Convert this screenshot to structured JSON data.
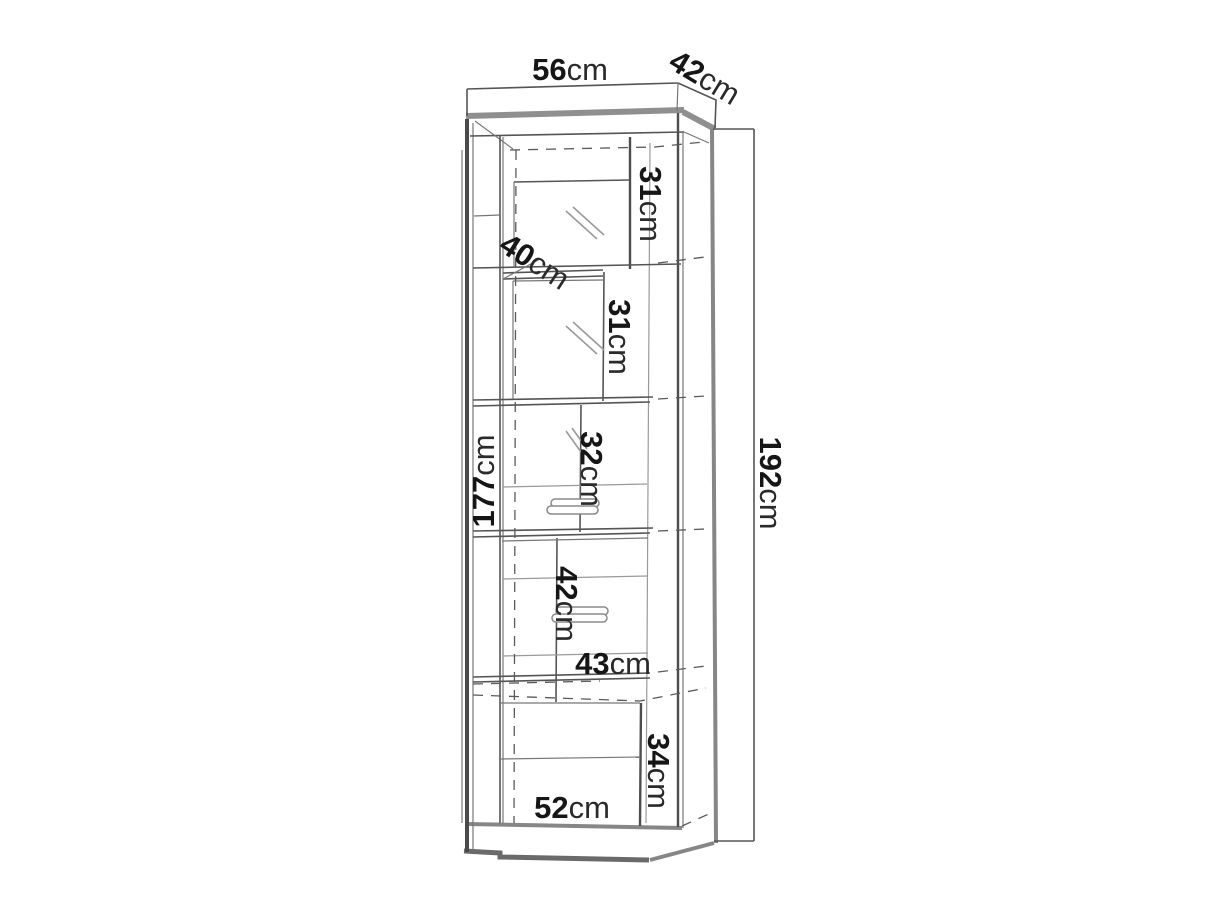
{
  "diagram": {
    "type": "furniture-dimension-drawing",
    "subject": "tall display cabinet, front elevation with dimension lines",
    "unit": "cm",
    "labels": {
      "top_width": {
        "value": "56",
        "unit": "cm"
      },
      "top_depth": {
        "value": "42",
        "unit": "cm"
      },
      "upper_shelf_1": {
        "value": "31",
        "unit": "cm"
      },
      "glass_door_width": {
        "value": "40",
        "unit": "cm"
      },
      "upper_shelf_2": {
        "value": "31",
        "unit": "cm"
      },
      "middle_shelf": {
        "value": "32",
        "unit": "cm"
      },
      "interior_height": {
        "value": "177",
        "unit": "cm"
      },
      "total_height": {
        "value": "192",
        "unit": "cm"
      },
      "lower_door_height": {
        "value": "42",
        "unit": "cm"
      },
      "lower_door_width": {
        "value": "43",
        "unit": "cm"
      },
      "base_height": {
        "value": "34",
        "unit": "cm"
      },
      "base_width": {
        "value": "52",
        "unit": "cm"
      }
    },
    "colors": {
      "background": "#ffffff",
      "line_dark": "#4d4d4d",
      "line_soft": "#8f8f8f",
      "text": "#1b1b1b"
    }
  }
}
